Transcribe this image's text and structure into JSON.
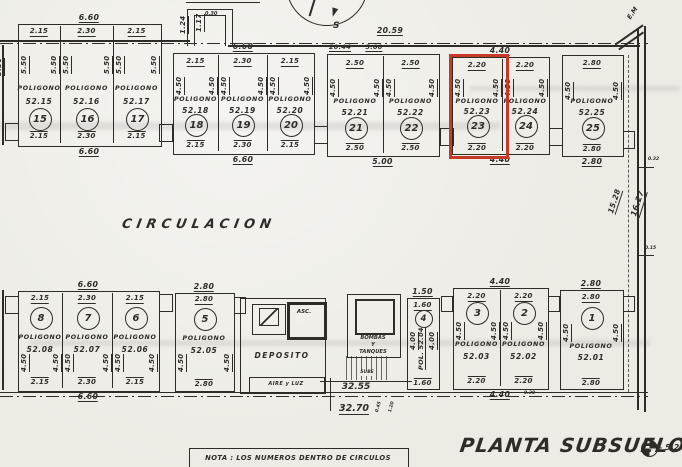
{
  "drawing": {
    "title": "PLANTA SUBSUELO 2",
    "level": "- 5.2",
    "note": "NOTA : LOS NUMEROS DENTRO DE CIRCULOS",
    "circulation_label": "CIRCULACION",
    "poligono_word": "POLIGONO",
    "compass_south": "S",
    "highlight_color": "#c83a28"
  },
  "rooms": {
    "deposit": "DEPOSITO",
    "air_light": "AIRE y LUZ",
    "elevator": "ASC.",
    "pumps_lines": [
      "BOMBAS",
      "Y",
      "TANQUES"
    ],
    "stairs_up": "SUBE"
  },
  "site_dimensions": {
    "vent_shaft_label": "VENTILACION CENTRAL",
    "vent_step_a": "1.24",
    "vent_step_b": "1.17",
    "vent_width": "0.30",
    "top_total": "20.59",
    "top_left_segment": "20.44",
    "top_segment": "5.00",
    "corner_mark": "E.M",
    "right_inner": "15.28",
    "right_outer": "16.27",
    "right_tick_top": "0.32",
    "right_tick_bottom": "0.15",
    "left_partial_depth": "5.50",
    "stairs_width": "32.55",
    "bottom_total": "32.70",
    "bottom_tick_a": "0.45",
    "bottom_tick_b": "1.20"
  },
  "blocks": [
    {
      "id": "A",
      "above": "6.60",
      "below": "6.60",
      "spaces": [
        {
          "num": "15",
          "code": "52.15",
          "width": "2.15",
          "depth": "5.50"
        },
        {
          "num": "16",
          "code": "52.16",
          "width": "2.30",
          "depth": "5.50"
        },
        {
          "num": "17",
          "code": "52.17",
          "width": "2.15",
          "depth": "5.50"
        }
      ]
    },
    {
      "id": "B",
      "above": "6.60",
      "below": "6.60",
      "spaces": [
        {
          "num": "18",
          "code": "52.18",
          "width": "2.15",
          "depth": "4.50"
        },
        {
          "num": "19",
          "code": "52.19",
          "width": "2.30",
          "depth": "4.50"
        },
        {
          "num": "20",
          "code": "52.20",
          "width": "2.15",
          "depth": "4.50"
        }
      ]
    },
    {
      "id": "C",
      "above": null,
      "below": "5.00",
      "spaces": [
        {
          "num": "21",
          "code": "52.21",
          "width": "2.50",
          "depth": "4.50"
        },
        {
          "num": "22",
          "code": "52.22",
          "width": "2.50",
          "depth": "4.50"
        }
      ]
    },
    {
      "id": "D",
      "above": "4.40",
      "below": "4.40",
      "spaces": [
        {
          "num": "23",
          "code": "52.23",
          "width": "2.20",
          "depth": "4.50",
          "highlighted": true
        },
        {
          "num": "24",
          "code": "52.24",
          "width": "2.20",
          "depth": "4.50"
        }
      ]
    },
    {
      "id": "E",
      "above": null,
      "below": "2.80",
      "spaces": [
        {
          "num": "25",
          "code": "52.25",
          "width": "2.80",
          "depth": "4.50"
        }
      ]
    },
    {
      "id": "F",
      "above": "6.60",
      "below": "6.60",
      "spaces": [
        {
          "num": "8",
          "code": "52.08",
          "width": "2.15",
          "depth": "4.50"
        },
        {
          "num": "7",
          "code": "52.07",
          "width": "2.30",
          "depth": "4.50"
        },
        {
          "num": "6",
          "code": "52.06",
          "width": "2.15",
          "depth": "4.50"
        }
      ]
    },
    {
      "id": "G",
      "above": "2.80",
      "below": null,
      "spaces": [
        {
          "num": "5",
          "code": "52.05",
          "width": "2.80",
          "depth": "4.50"
        }
      ]
    },
    {
      "id": "H",
      "above": "1.50",
      "below": null,
      "spaces": [
        {
          "num": "4",
          "code": "POL. 52.04",
          "width": "1.60",
          "depth": "4.00"
        }
      ]
    },
    {
      "id": "I",
      "above": "4.40",
      "below": "4.40",
      "below_extra": "0.30",
      "spaces": [
        {
          "num": "3",
          "code": "52.03",
          "width": "2.20",
          "depth": "4.50"
        },
        {
          "num": "2",
          "code": "52.02",
          "width": "2.20",
          "depth": "4.50"
        }
      ]
    },
    {
      "id": "J",
      "above": "2.80",
      "below": null,
      "spaces": [
        {
          "num": "1",
          "code": "52.01",
          "width": "2.80",
          "depth": "4.50"
        }
      ]
    }
  ]
}
